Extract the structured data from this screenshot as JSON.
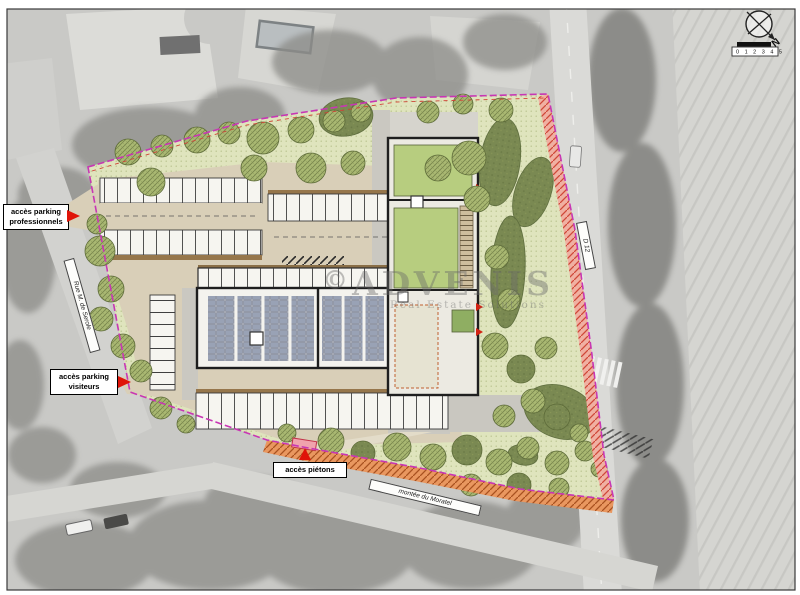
{
  "annotations": {
    "access_professional": {
      "label": "accès parking professionnels"
    },
    "access_visitors": {
      "label": "accès parking visiteurs"
    },
    "access_pedestrian": {
      "label": "accès piétons"
    }
  },
  "road_labels": {
    "west": "Rue M. de Serole",
    "south": "montée du Moratel",
    "east": "D 12"
  },
  "compass": {
    "north": "N"
  },
  "scale_bar": {
    "labels": "0 1 2 3 4 5"
  },
  "watermark": {
    "mark": "©",
    "brand": "ADVENIS",
    "tagline": "Real Estate Solutions"
  },
  "colors": {
    "site_green_bg": "#dfe4bd",
    "tree_green": "#a9b872",
    "basin_dark_green": "#7a8952",
    "lawn_green": "#b7cd7f",
    "paving_beige": "#d9cfb8",
    "kerb_brown": "#96764b",
    "solar_panel_blue": "#99a2b5",
    "boundary_magenta": "#c836b4",
    "hatch_red": "#cf4838",
    "hatch_orange": "#a8511f",
    "accent_red": "#e01408"
  }
}
